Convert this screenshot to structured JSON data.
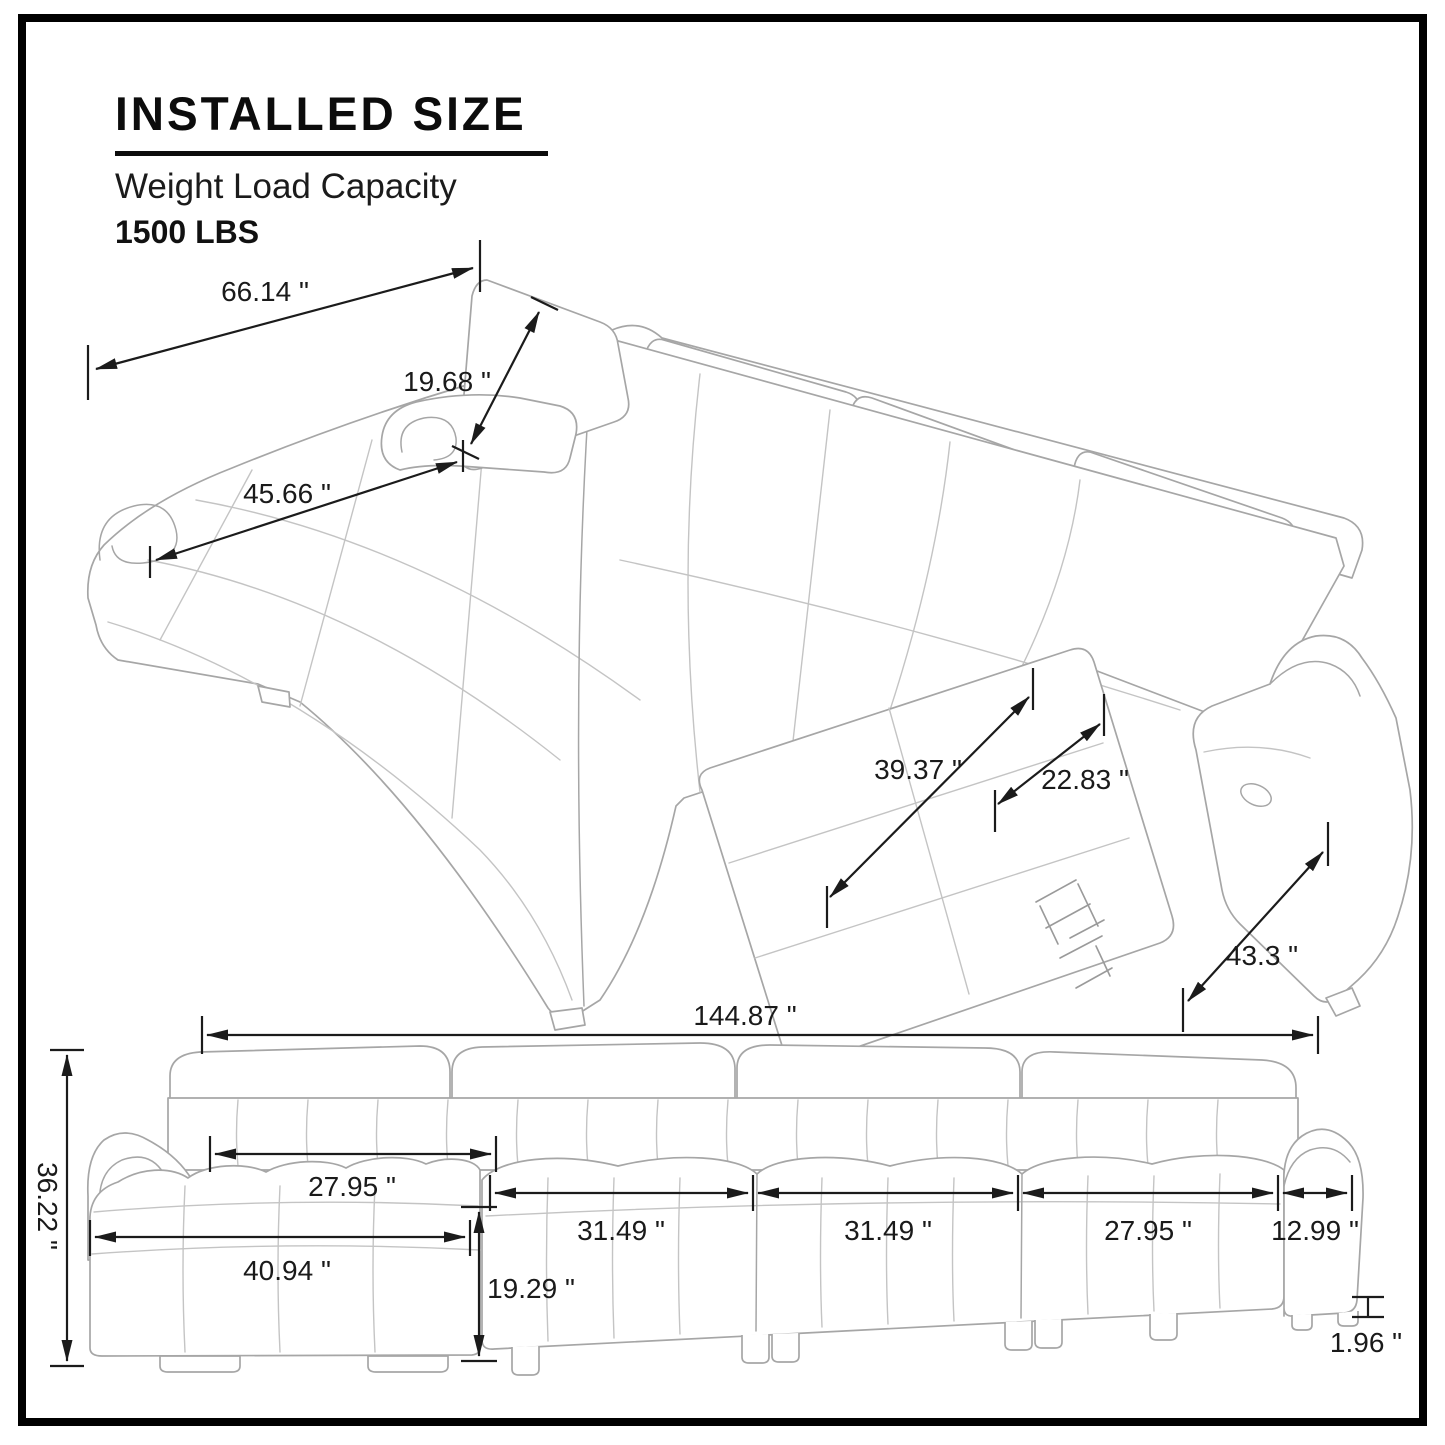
{
  "header": {
    "title": "INSTALLED SIZE",
    "subtitle": "Weight Load Capacity",
    "capacity": "1500 LBS"
  },
  "top_view": {
    "back_width": "66.14 \"",
    "headrest_length": "19.68 \"",
    "chaise_length": "45.66 \"",
    "recliner_extension": "39.37 \"",
    "seat_depth": "22.83 \"",
    "side_depth": "43.3 \""
  },
  "front_view": {
    "overall_width": "144.87 \"",
    "overall_height": "36.22 \"",
    "chaise_inner_width": "27.95 \"",
    "chaise_outer_width": "40.94 \"",
    "chaise_height": "19.29 \"",
    "seat_widths": [
      "31.49 \"",
      "31.49 \"",
      "27.95 \""
    ],
    "arm_width": "12.99 \"",
    "leg_height": "1.96 \""
  }
}
